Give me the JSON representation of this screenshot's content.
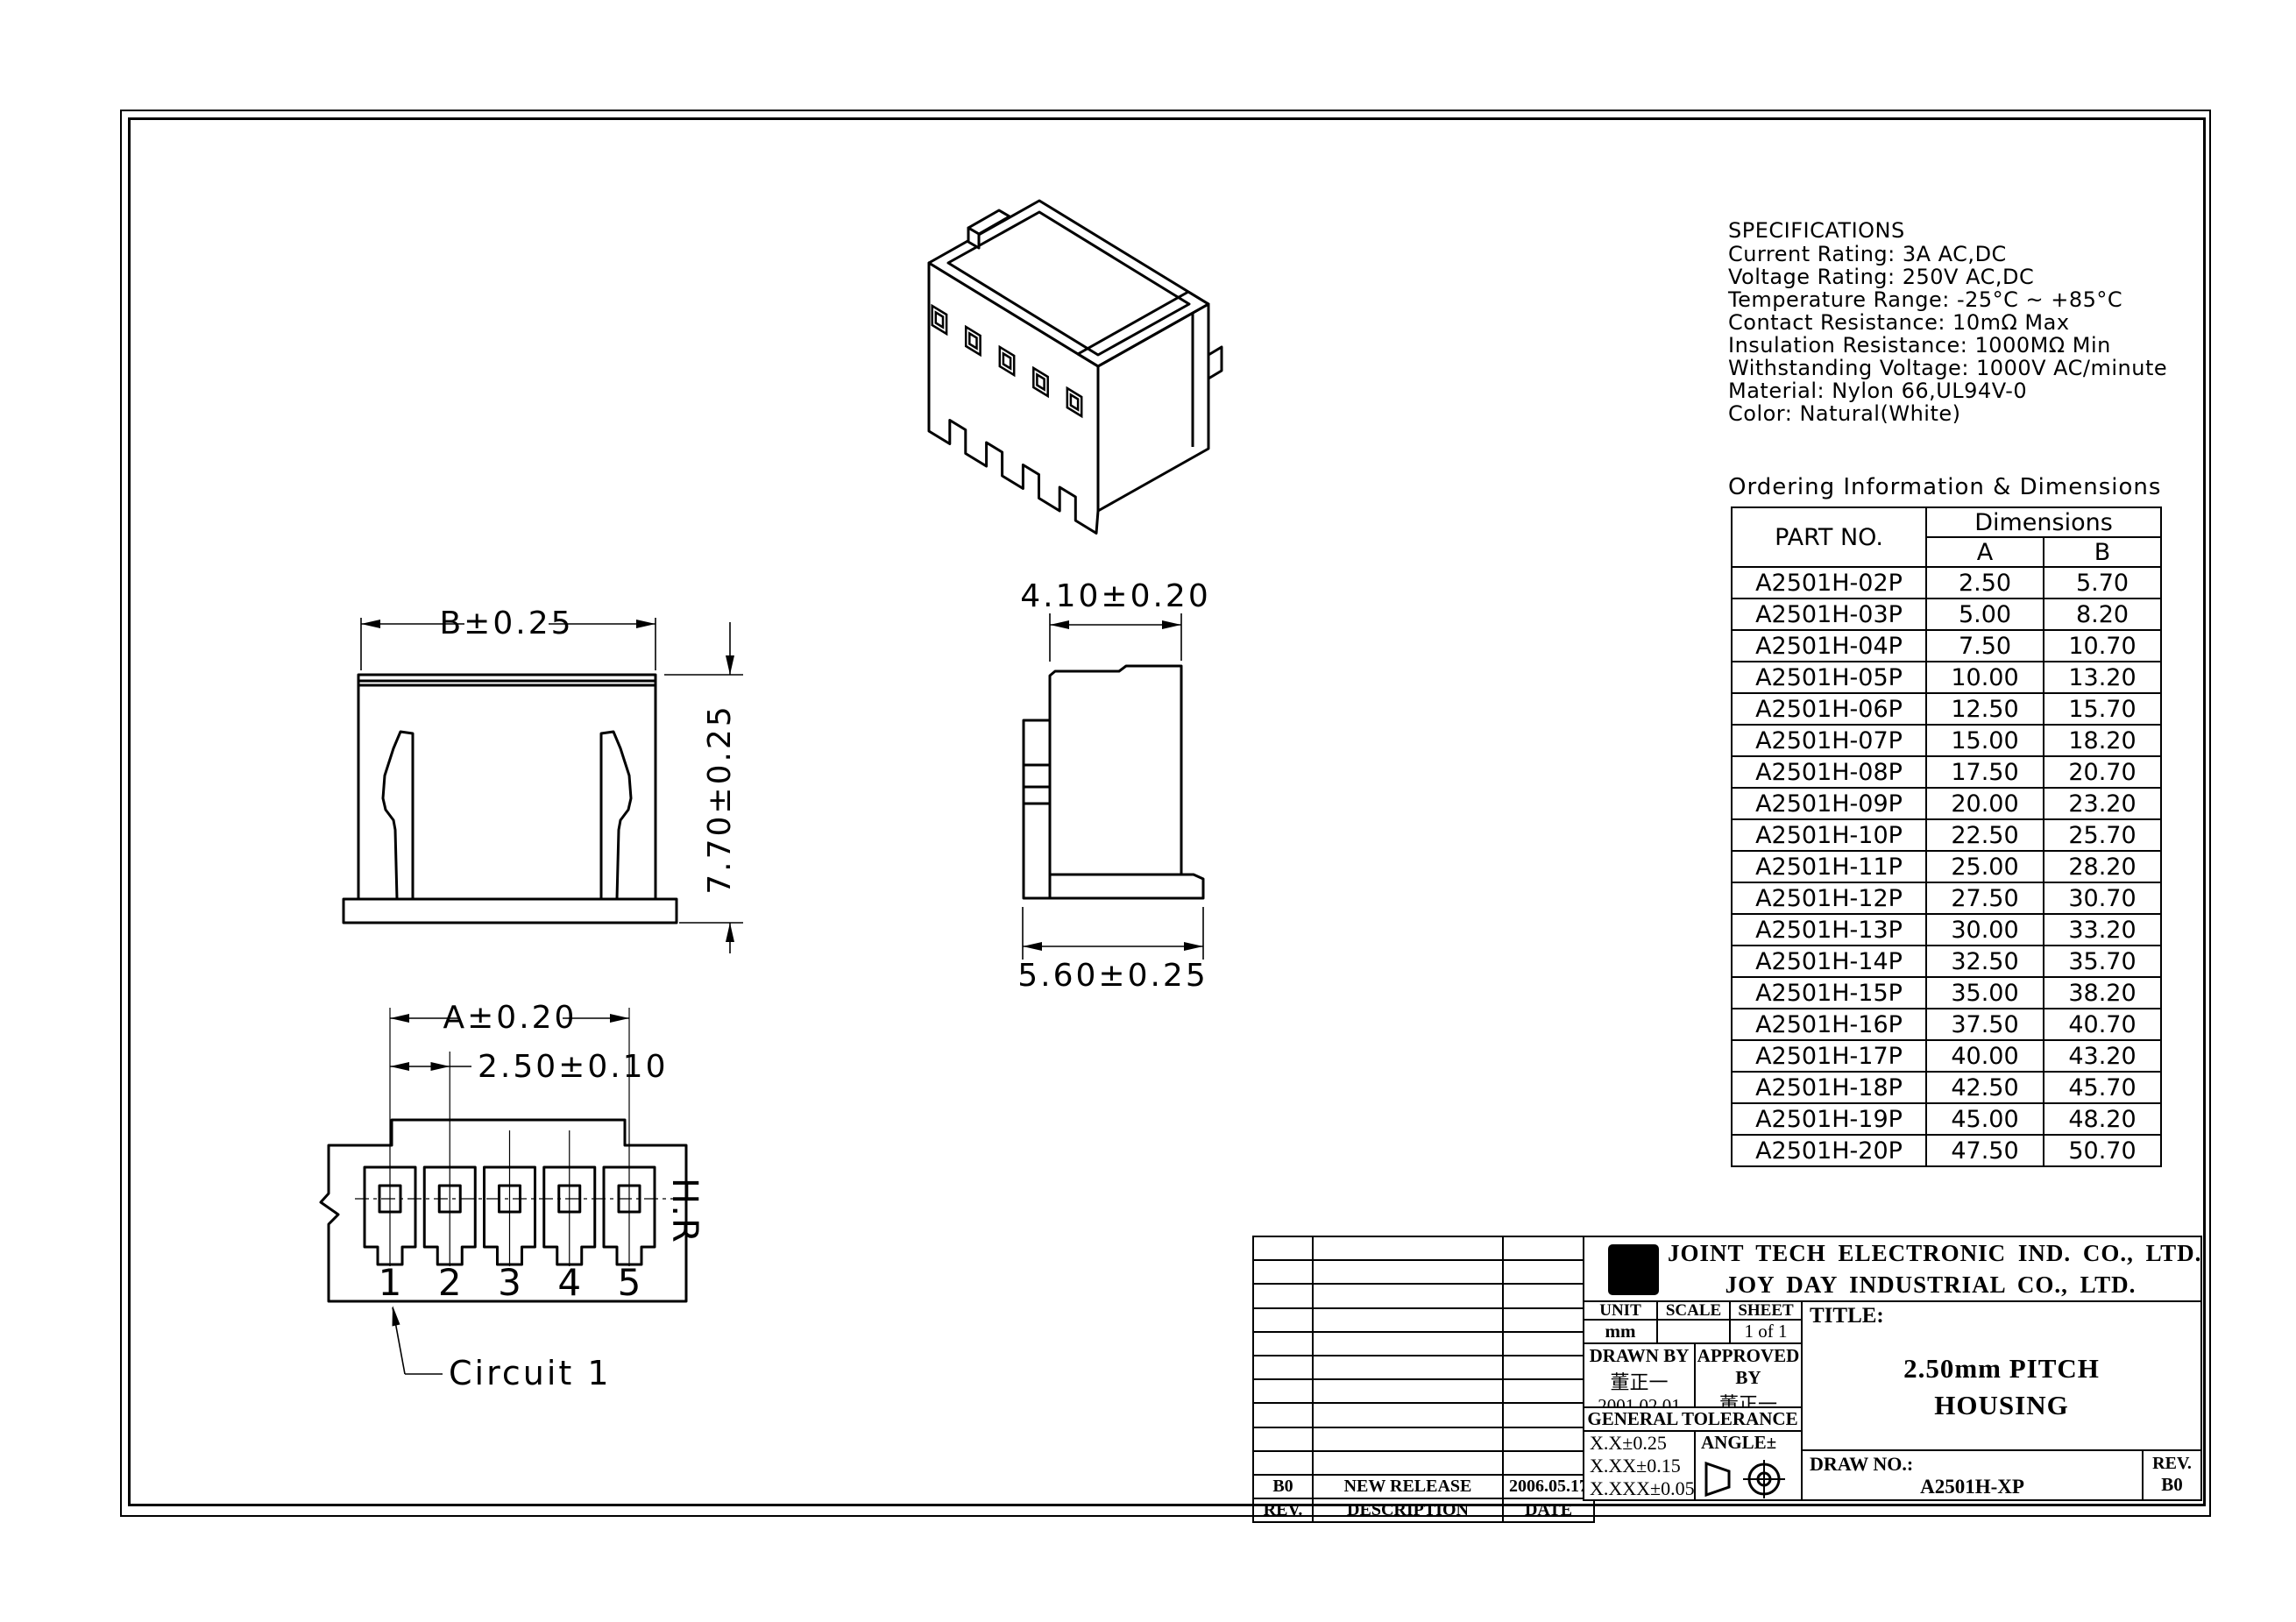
{
  "specifications": {
    "title": "SPECIFICATIONS",
    "lines": [
      "Current Rating: 3A AC,DC",
      "Voltage Rating: 250V AC,DC",
      "Temperature Range: -25°C ~ +85°C",
      "Contact Resistance: 10mΩ Max",
      "Insulation Resistance: 1000MΩ Min",
      "Withstanding Voltage: 1000V AC/minute",
      "Material: Nylon 66,UL94V-0",
      "Color: Natural(White)"
    ]
  },
  "ordering": {
    "title": "Ordering Information & Dimensions",
    "col_part": "PART NO.",
    "col_dims": "Dimensions",
    "col_a": "A",
    "col_b": "B",
    "rows": [
      {
        "part": "A2501H-02P",
        "a": "2.50",
        "b": "5.70"
      },
      {
        "part": "A2501H-03P",
        "a": "5.00",
        "b": "8.20"
      },
      {
        "part": "A2501H-04P",
        "a": "7.50",
        "b": "10.70"
      },
      {
        "part": "A2501H-05P",
        "a": "10.00",
        "b": "13.20"
      },
      {
        "part": "A2501H-06P",
        "a": "12.50",
        "b": "15.70"
      },
      {
        "part": "A2501H-07P",
        "a": "15.00",
        "b": "18.20"
      },
      {
        "part": "A2501H-08P",
        "a": "17.50",
        "b": "20.70"
      },
      {
        "part": "A2501H-09P",
        "a": "20.00",
        "b": "23.20"
      },
      {
        "part": "A2501H-10P",
        "a": "22.50",
        "b": "25.70"
      },
      {
        "part": "A2501H-11P",
        "a": "25.00",
        "b": "28.20"
      },
      {
        "part": "A2501H-12P",
        "a": "27.50",
        "b": "30.70"
      },
      {
        "part": "A2501H-13P",
        "a": "30.00",
        "b": "33.20"
      },
      {
        "part": "A2501H-14P",
        "a": "32.50",
        "b": "35.70"
      },
      {
        "part": "A2501H-15P",
        "a": "35.00",
        "b": "38.20"
      },
      {
        "part": "A2501H-16P",
        "a": "37.50",
        "b": "40.70"
      },
      {
        "part": "A2501H-17P",
        "a": "40.00",
        "b": "43.20"
      },
      {
        "part": "A2501H-18P",
        "a": "42.50",
        "b": "45.70"
      },
      {
        "part": "A2501H-19P",
        "a": "45.00",
        "b": "48.20"
      },
      {
        "part": "A2501H-20P",
        "a": "47.50",
        "b": "50.70"
      }
    ]
  },
  "views": {
    "front": {
      "dim_width": "B±0.25",
      "dim_height": "7.70±0.25"
    },
    "side": {
      "dim_top": "4.10±0.20",
      "dim_bottom": "5.60±0.25"
    },
    "bottom": {
      "dim_span": "A±0.20",
      "dim_pitch": "2.50±0.10",
      "pins": [
        "1",
        "2",
        "3",
        "4",
        "5"
      ],
      "marking": "H.R",
      "circuit_label": "Circuit 1"
    }
  },
  "title_block": {
    "logo_text": "HR",
    "company_line1": "JOINT TECH ELECTRONIC IND. CO., LTD.",
    "company_line2": "JOY DAY INDUSTRIAL CO., LTD.",
    "unit_label": "UNIT",
    "unit_value": "mm",
    "scale_label": "SCALE",
    "scale_value": "",
    "sheet_label": "SHEET",
    "sheet_value": "1 of 1",
    "drawn_label": "DRAWN BY",
    "drawn_name": "董正一",
    "drawn_date": "2001.02.01",
    "approved_label": "APPROVED BY",
    "approved_name": "董正一",
    "approved_date": "2001.02.01",
    "tolerance_title": "GENERAL TOLERANCE",
    "tolerances": [
      "X.X±0.25",
      "X.XX±0.15",
      "X.XXX±0.05"
    ],
    "angle_label": "ANGLE±",
    "title_label": "TITLE:",
    "title_line1": "2.50mm PITCH",
    "title_line2": "HOUSING",
    "draw_no_label": "DRAW NO.:",
    "draw_no": "A2501H-XP",
    "rev_label": "REV.",
    "rev_value": "B0",
    "revision_table": {
      "headers": [
        "REV.",
        "DESCRIPTION",
        "DATE"
      ],
      "rows": [
        {
          "rev": "B0",
          "description": "NEW RELEASE",
          "date": "2006.05.17"
        }
      ],
      "empty_row_count": 10
    }
  }
}
